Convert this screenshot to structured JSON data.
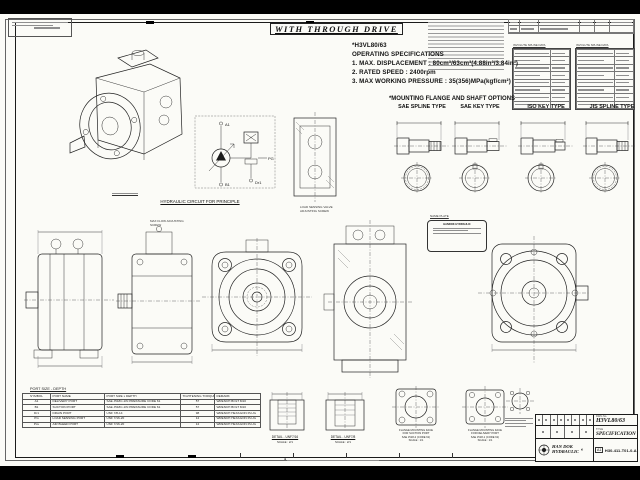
{
  "frame": {
    "title_box": "WITH THROUGH DRIVE"
  },
  "specs": {
    "model": "*H3VL80/63",
    "heading": "OPERATING SPECIFICATIONS",
    "line1": "1. MAX. DISPLACEMENT : 80cm³/63cm³(4.88in³/3.84in³)",
    "line2": "2. RATED SPEED : 2400rpm",
    "line3": "3. MAX WORKING PRESSURE : 35(356)MPa(kgf/cm²)"
  },
  "options": {
    "heading": "*MOUNTING FLANGE AND SHAFT OPTIONS",
    "type1": "SAE SPLINE TYPE",
    "type2": "SAE KEY TYPE",
    "type3": "ISO KEY TYPE",
    "type4": "JIS SPLINE TYPE"
  },
  "spline_data": {
    "title": "INVOLUTE SPLINE DATA"
  },
  "circuit": {
    "label": "HYDRAULIC CIRCUIT FOR PRINCIPLE",
    "port_a": "A1",
    "port_b": "B1",
    "port_dr": "Dr1",
    "port_pg": "PG"
  },
  "callouts": {
    "max_flow": "MAX FLOW ADJUSTING SCREW",
    "load_sensing": "LOAD SENSING VALVE ADJUSTING SCREW",
    "name_plate": "NAME PLATE",
    "brand": "HANDOK HYDRAULIC"
  },
  "port_table": {
    "title": "PORT SIZE - DEPTH",
    "h_symbol": "SYMBOL",
    "h_name": "PORT NAME",
    "h_size": "PORT SIZE x DEPTH",
    "h_torque": "TIGHTENING TORQUE (Nm)",
    "h_remark": "REMARK",
    "rows": [
      {
        "symbol": "A1",
        "name": "DELIVERY PORT",
        "size": "SAE J518C-1IN PRESSURE CODE 61",
        "torque": "57",
        "remark": "WRENCH BOLT M10"
      },
      {
        "symbol": "B1",
        "name": "SUCTION PORT",
        "size": "SAE J518C-1IN PRESSURE CODE 61",
        "torque": "57",
        "remark": "WRENCH BOLT M10"
      },
      {
        "symbol": "Dr1",
        "name": "DRAIN PORT",
        "size": "UNF 7/8-14",
        "torque": "98",
        "remark": "WRENCH HEXAGON PLUG"
      },
      {
        "symbol": "PG",
        "name": "LOAD SENSING PORT",
        "size": "UNF 7/16-20",
        "torque": "12",
        "remark": "WRENCH HEXAGON PLUG"
      },
      {
        "symbol": "Psv",
        "name": "AIR BLEED PORT",
        "size": "UNF 7/16-20",
        "torque": "12",
        "remark": "WRENCH HEXAGON PLUG"
      }
    ]
  },
  "details": {
    "d1_label": "DETAIL - UNF7/16",
    "d1_scale": "SCALE : 2/1",
    "d2_label": "DETAIL - UNF7/8",
    "d2_scale": "SCALE : 2/1",
    "suction1": "FLANGE MOUNTING FACE",
    "suction2": "FOR SUCTION PORT",
    "suction3": "SAE J518-2 (CODE 61)",
    "suction_scale": "SCALE : 1/1",
    "delivery1": "FLANGE MOUNTING FACE",
    "delivery2": "FOR DELIVERY PORT",
    "delivery3": "SAE J518-1 (CODE 61)",
    "delivery_scale": "SCALE : 1/1"
  },
  "title_block": {
    "dwg_label": "DWG No.",
    "dwg_no": "H3VL80/63",
    "title_label": "TITLE",
    "title": "SPECIFICATION",
    "company1": "HAN DOK",
    "company2": "HYDRAULIC",
    "size": "A1",
    "number": "H30-411-T01-0-A"
  }
}
